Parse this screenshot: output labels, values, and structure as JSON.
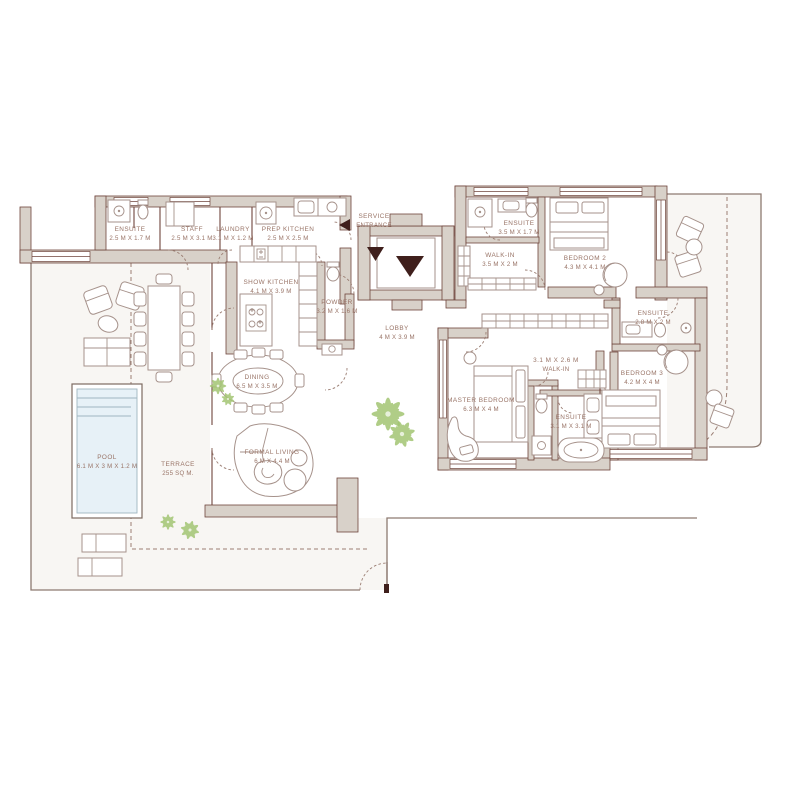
{
  "plan": {
    "title": "Residence Floor Plan",
    "colors": {
      "wall": "#d8d1c9",
      "line": "#6f453c",
      "furn": "#a6928b",
      "text": "#997467",
      "accent": "#3f1f1c",
      "pool": "#e7f1f7",
      "plant": "#a3c573",
      "dash": "#9b7e73",
      "terr": "#f8f6f3"
    },
    "labels": [
      {
        "id": "staff-ensuite",
        "line1": "ENSUITE",
        "line2": "2.5 M X 1.7 M"
      },
      {
        "id": "staff",
        "line1": "STAFF",
        "line2": "2.5 M X 3.1 M"
      },
      {
        "id": "laundry",
        "line1": "LAUNDRY",
        "line2": "3.1 M X 1.2 M"
      },
      {
        "id": "prep-kitchen",
        "line1": "PREP KITCHEN",
        "line2": "2.5 M X 2.5 M"
      },
      {
        "id": "service-entrance",
        "line1": "SERVICE",
        "line2": "ENTRANCE"
      },
      {
        "id": "show-kitchen",
        "line1": "SHOW KITCHEN",
        "line2": "4.1 M X 3.9 M"
      },
      {
        "id": "powder",
        "line1": "POWDER",
        "line2": "3.2 M X 1.6 M"
      },
      {
        "id": "lobby",
        "line1": "LOBBY",
        "line2": "4 M X 3.9 M"
      },
      {
        "id": "bedroom2-ensuite",
        "line1": "ENSUITE",
        "line2": "3.5 M X 1.7 M"
      },
      {
        "id": "bedroom2-walkin",
        "line1": "WALK-IN",
        "line2": "3.5 M X 2 M"
      },
      {
        "id": "bedroom2",
        "line1": "BEDROOM 2",
        "line2": "4.3 M X 4.1 M"
      },
      {
        "id": "bedroom3-ensuite",
        "line1": "ENSUITE",
        "line2": "2.8 M X 2 M"
      },
      {
        "id": "bedroom3",
        "line1": "BEDROOM 3",
        "line2": "4.2 M X 4 M"
      },
      {
        "id": "master-walkin",
        "line1": "3.1 M X 2.6 M",
        "line2": "WALK-IN"
      },
      {
        "id": "master-bedroom",
        "line1": "MASTER BEDROOM",
        "line2": "6.3 M X 4 M"
      },
      {
        "id": "master-ensuite",
        "line1": "ENSUITE",
        "line2": "3.1 M X 3.1 M"
      },
      {
        "id": "dining",
        "line1": "DINING",
        "line2": "6.5 M X 3.5 M"
      },
      {
        "id": "formal-living",
        "line1": "FORMAL LIVING",
        "line2": "6 M X 4.4 M"
      },
      {
        "id": "pool",
        "line1": "POOL",
        "line2": "6.1 M x 3 M x 1.2 M"
      },
      {
        "id": "terrace",
        "line1": "TERRACE",
        "line2": "255 SQ M."
      }
    ]
  }
}
